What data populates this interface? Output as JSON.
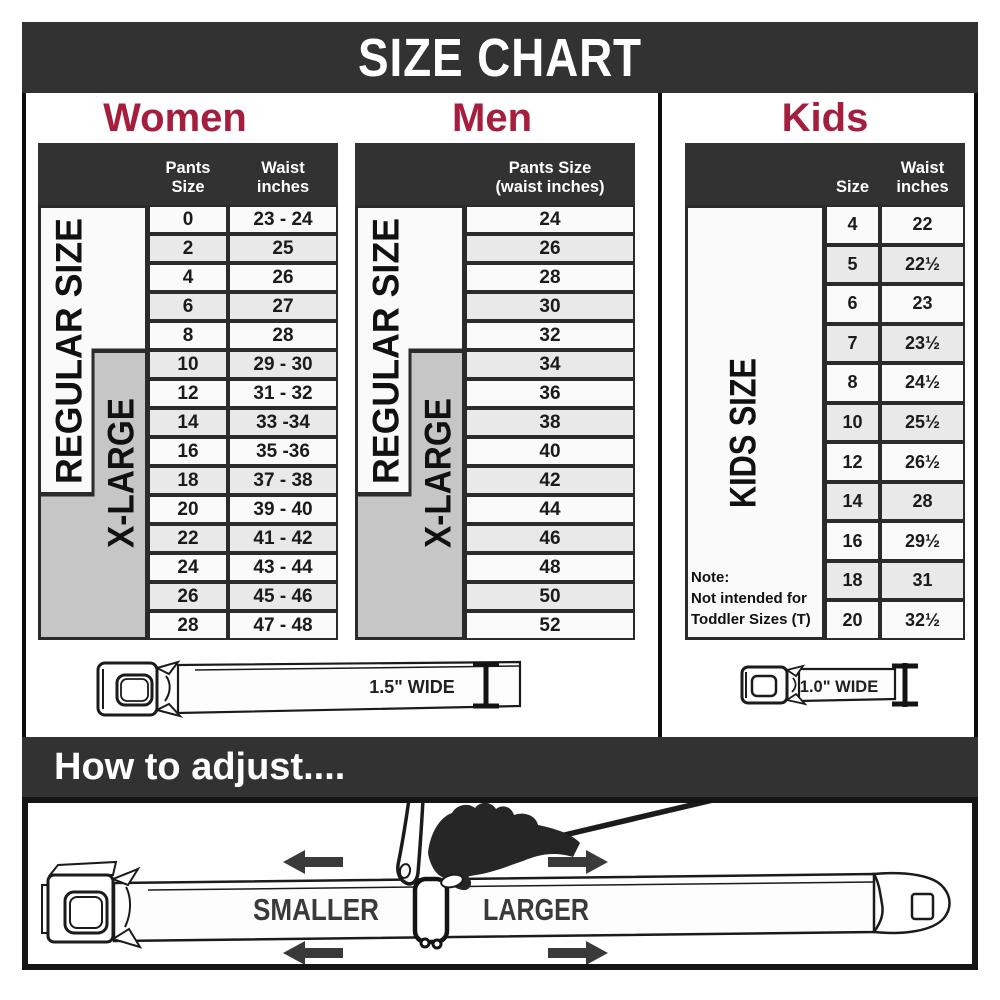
{
  "title": "SIZE CHART",
  "colors": {
    "accent": "#a61e3e",
    "header_dark": "#323232",
    "row_light": "#fafafa",
    "row_shaded": "#e9e9e9",
    "xlarge_gray": "#c6c6c6"
  },
  "women": {
    "heading": "Women",
    "col_pants": "Pants Size",
    "col_waist_line1": "Waist",
    "col_waist_line2": "inches",
    "regular_label": "REGULAR SIZE",
    "xlarge_label": "X-LARGE",
    "rows": [
      {
        "size": "0",
        "waist": "23 - 24"
      },
      {
        "size": "2",
        "waist": "25"
      },
      {
        "size": "4",
        "waist": "26"
      },
      {
        "size": "6",
        "waist": "27"
      },
      {
        "size": "8",
        "waist": "28"
      },
      {
        "size": "10",
        "waist": "29 - 30"
      },
      {
        "size": "12",
        "waist": "31 - 32"
      },
      {
        "size": "14",
        "waist": "33 -34"
      },
      {
        "size": "16",
        "waist": "35 -36"
      },
      {
        "size": "18",
        "waist": "37 - 38"
      },
      {
        "size": "20",
        "waist": "39 - 40"
      },
      {
        "size": "22",
        "waist": "41 - 42"
      },
      {
        "size": "24",
        "waist": "43 - 44"
      },
      {
        "size": "26",
        "waist": "45 - 46"
      },
      {
        "size": "28",
        "waist": "47 - 48"
      }
    ]
  },
  "men": {
    "heading": "Men",
    "col_line1": "Pants Size",
    "col_line2": "(waist inches)",
    "regular_label": "REGULAR SIZE",
    "xlarge_label": "X-LARGE",
    "rows": [
      "24",
      "26",
      "28",
      "30",
      "32",
      "34",
      "36",
      "38",
      "40",
      "42",
      "44",
      "46",
      "48",
      "50",
      "52"
    ]
  },
  "kids": {
    "heading": "Kids",
    "col_size": "Size",
    "col_waist_line1": "Waist",
    "col_waist_line2": "inches",
    "size_label": "KIDS SIZE",
    "note_line1": "Note:",
    "note_line2": "Not intended for",
    "note_line3": "Toddler Sizes (T)",
    "rows": [
      {
        "size": "4",
        "waist": "22"
      },
      {
        "size": "5",
        "waist": "22½"
      },
      {
        "size": "6",
        "waist": "23"
      },
      {
        "size": "7",
        "waist": "23½"
      },
      {
        "size": "8",
        "waist": "24½"
      },
      {
        "size": "10",
        "waist": "25½"
      },
      {
        "size": "12",
        "waist": "26½"
      },
      {
        "size": "14",
        "waist": "28"
      },
      {
        "size": "16",
        "waist": "29½"
      },
      {
        "size": "18",
        "waist": "31"
      },
      {
        "size": "20",
        "waist": "32½"
      }
    ]
  },
  "belts": {
    "adult_label": "1.5\" WIDE",
    "kids_label": "1.0\" WIDE"
  },
  "adjust": {
    "heading": "How to adjust....",
    "smaller_label": "SMALLER",
    "larger_label": "LARGER"
  }
}
